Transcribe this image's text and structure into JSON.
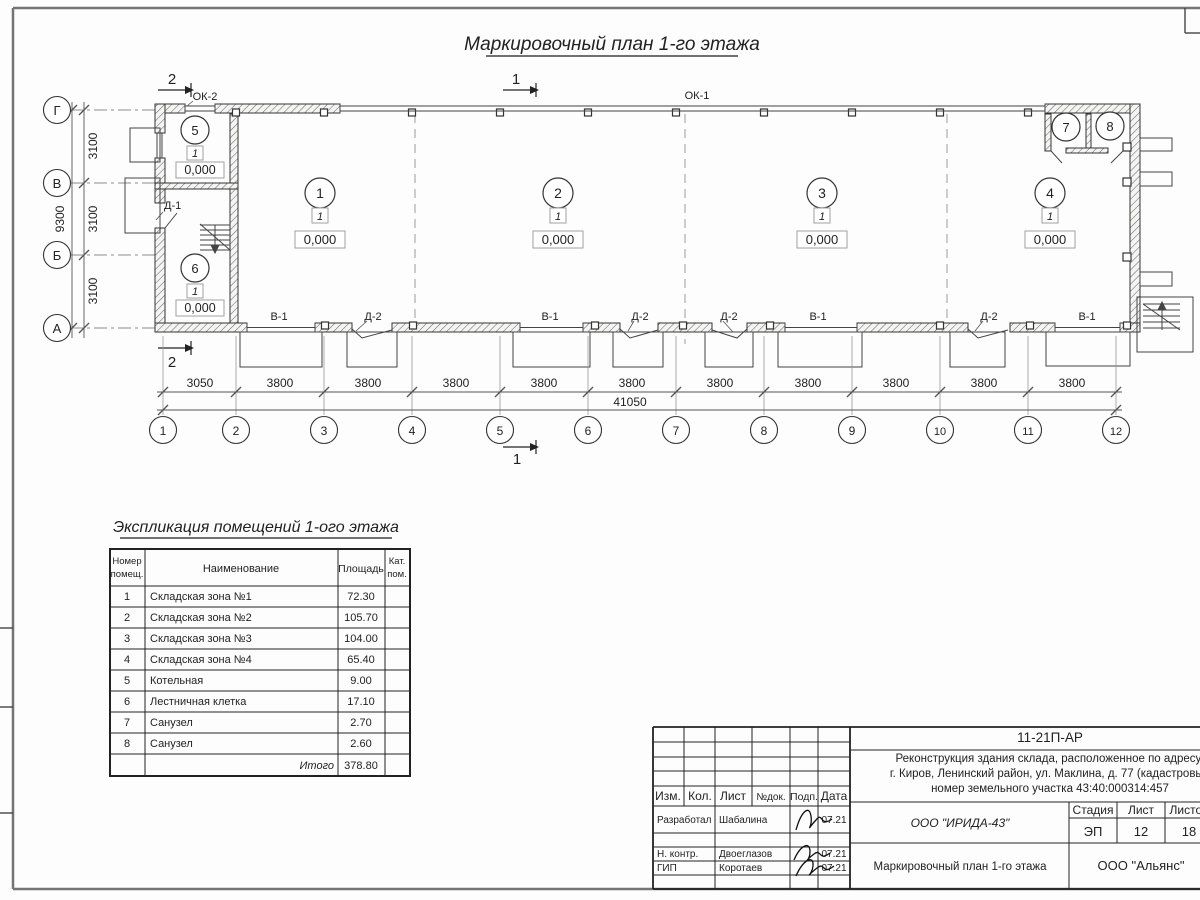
{
  "sheet": {
    "plan_title": "Маркировочный план 1-го этажа",
    "explication_title": "Экспликация помещений 1-ого этажа"
  },
  "plan": {
    "section_mark_1": "1",
    "section_mark_2": "2",
    "window_label_ok1": "ОК-1",
    "window_label_ok2": "ОК-2",
    "door_label_d1": "Д-1",
    "axis_letters": [
      "Г",
      "В",
      "Б",
      "А"
    ],
    "axis_numbers": [
      "1",
      "2",
      "3",
      "4",
      "5",
      "6",
      "7",
      "8",
      "9",
      "10",
      "11",
      "12"
    ],
    "vdim_segments": [
      "3100",
      "3100",
      "3100"
    ],
    "vdim_total": "9300",
    "hdim_segments": [
      "3050",
      "3800",
      "3800",
      "3800",
      "3800",
      "3800",
      "3800",
      "3800",
      "3800",
      "3800",
      "3800"
    ],
    "hdim_total": "41050",
    "bottom_openings": [
      "В-1",
      "Д-2",
      "В-1",
      "Д-2",
      "Д-2",
      "В-1",
      "Д-2",
      "В-1"
    ],
    "zone_rooms": [
      {
        "number": "1",
        "type_mark": "1",
        "elevation": "0,000"
      },
      {
        "number": "2",
        "type_mark": "1",
        "elevation": "0,000"
      },
      {
        "number": "3",
        "type_mark": "1",
        "elevation": "0,000"
      },
      {
        "number": "4",
        "type_mark": "1",
        "elevation": "0,000"
      }
    ],
    "side_rooms": [
      {
        "number": "5",
        "type_mark": "1",
        "elevation": "0,000"
      },
      {
        "number": "6",
        "type_mark": "1",
        "elevation": "0,000"
      },
      {
        "number": "7"
      },
      {
        "number": "8"
      }
    ]
  },
  "explication": {
    "header": {
      "num_line1": "Номер",
      "num_line2": "помещ.",
      "name": "Наименование",
      "area": "Площадь",
      "cat_line1": "Кат.",
      "cat_line2": "пом."
    },
    "rows": [
      {
        "num": "1",
        "name": "Складская зона №1",
        "area": "72.30"
      },
      {
        "num": "2",
        "name": "Складская зона №2",
        "area": "105.70"
      },
      {
        "num": "3",
        "name": "Складская зона №3",
        "area": "104.00"
      },
      {
        "num": "4",
        "name": "Складская зона №4",
        "area": "65.40"
      },
      {
        "num": "5",
        "name": "Котельная",
        "area": "9.00"
      },
      {
        "num": "6",
        "name": "Лестничная клетка",
        "area": "17.10"
      },
      {
        "num": "7",
        "name": "Санузел",
        "area": "2.70"
      },
      {
        "num": "8",
        "name": "Санузел",
        "area": "2.60"
      }
    ],
    "total_label": "Итого",
    "total_area": "378.80"
  },
  "titleblock": {
    "doc_number": "11-21П-АР",
    "project_line1": "Реконструкция здания склада, расположенное по адресу:",
    "project_line2": "г. Киров, Ленинский район, ул. Маклина, д. 77 (кадастровый",
    "project_line3": "номер земельного участка 43:40:000314:457",
    "columns": {
      "izm": "Изм.",
      "kol": "Кол.",
      "list": "Лист",
      "doc": "№док.",
      "podp": "Подп.",
      "data": "Дата"
    },
    "signers": [
      {
        "role": "Разработал",
        "name": "Шабалина",
        "date": "07.21"
      },
      {
        "role": "Н. контр.",
        "name": "Двоеглазов",
        "date": "07.21"
      },
      {
        "role": "ГИП",
        "name": "Коротаев",
        "date": "07.21"
      }
    ],
    "designer_org": "ООО \"ИРИДА-43\"",
    "drawing_title": "Маркировочный план 1-го этажа",
    "stage_label": "Стадия",
    "sheet_label": "Лист",
    "sheets_label": "Листов",
    "stage": "ЭП",
    "sheet_num": "12",
    "sheets_total": "18",
    "customer_org": "ООО \"Альянс\""
  },
  "colors": {
    "line": "#2f2f2f",
    "frame": "#757575",
    "light_box": "#a0a0a0",
    "paper": "#fdfdfd"
  }
}
